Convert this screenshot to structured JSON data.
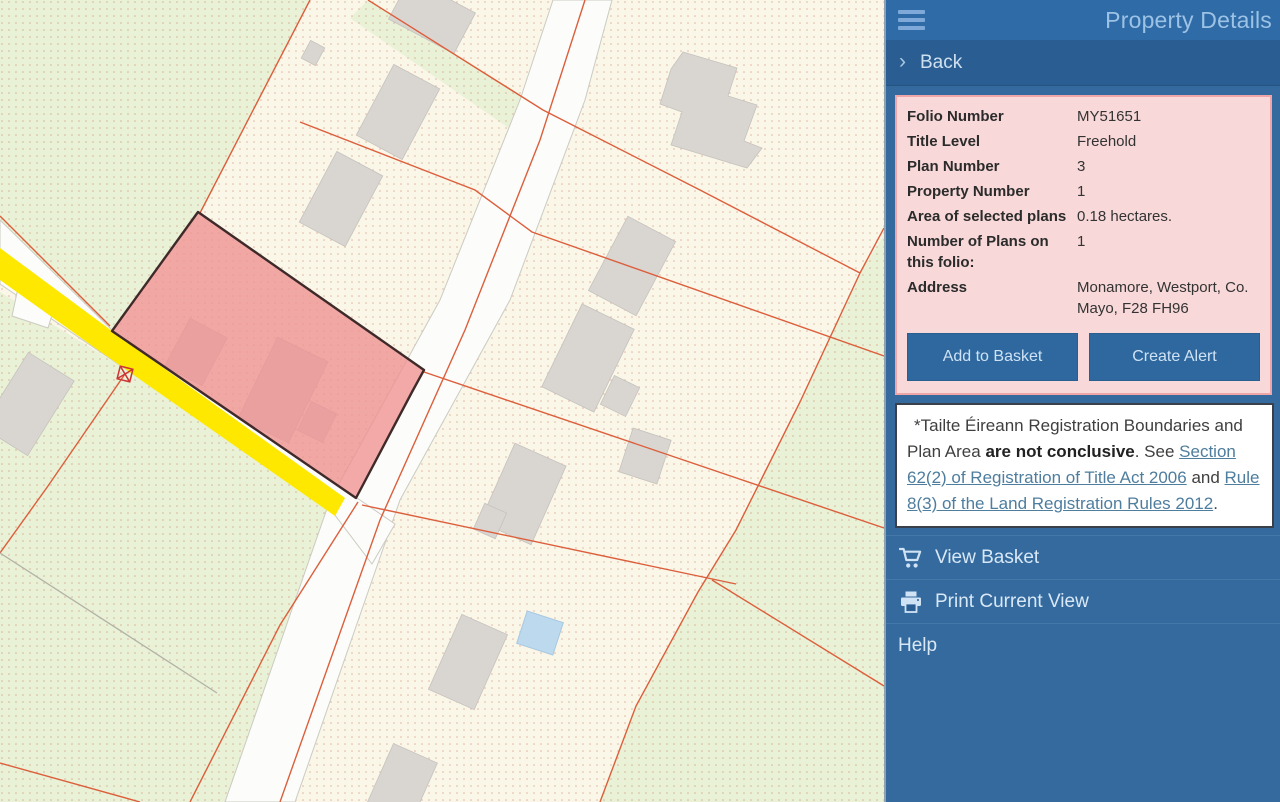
{
  "panel": {
    "title": "Property Details",
    "back_label": "Back",
    "details": {
      "rows": [
        {
          "label": "Folio Number",
          "value": "MY51651"
        },
        {
          "label": "Title Level",
          "value": "Freehold"
        },
        {
          "label": "Plan Number",
          "value": "3"
        },
        {
          "label": "Property Number",
          "value": "1"
        },
        {
          "label": "Area of selected plans",
          "value": "0.18 hectares."
        },
        {
          "label": "Number of Plans on this folio:",
          "value": "1"
        },
        {
          "label": "Address",
          "value": "Monamore, Westport, Co. Mayo, F28 FH96"
        }
      ]
    },
    "buttons": {
      "add_to_basket": "Add to Basket",
      "create_alert": "Create Alert"
    },
    "disclaimer": {
      "intro": "*Tailte Éireann Registration Boundaries and Plan Area ",
      "bold": "are not conclusive",
      "mid": ". See ",
      "link1": "Section 62(2) of Registration of Title Act 2006",
      "and": " and ",
      "link2": "Rule 8(3) of the Land Registration Rules 2012",
      "end": "."
    },
    "menu": {
      "items": [
        {
          "label": "View Basket",
          "icon": "cart-icon"
        },
        {
          "label": "Print Current View",
          "icon": "printer-icon"
        },
        {
          "label": "Help",
          "icon": ""
        }
      ]
    },
    "colors": {
      "header_bg": "#2f6ba6",
      "panel_bg": "#346a9e",
      "back_bg": "#2a5e93",
      "card_bg": "#f8d8d8",
      "card_border": "#f0a6a6",
      "button_bg": "#2e689e",
      "button_text": "#cfe2f5",
      "title_text": "#9cc2e5",
      "menu_text": "#d9e8f6",
      "link_color": "#4e7d9e"
    }
  },
  "map": {
    "colors": {
      "background": "#faf6e8",
      "field_green": "#e9f1d6",
      "selected_parcel": "#ee9191",
      "parcel_outline": "#3f2a2a",
      "highlighted_road": "#ffe800",
      "boundary_line": "#dc5f3c",
      "building": "#d9d6d2",
      "road": "#fcfcfa",
      "water": "#bcd9ee",
      "dot": "#c4735a"
    }
  }
}
